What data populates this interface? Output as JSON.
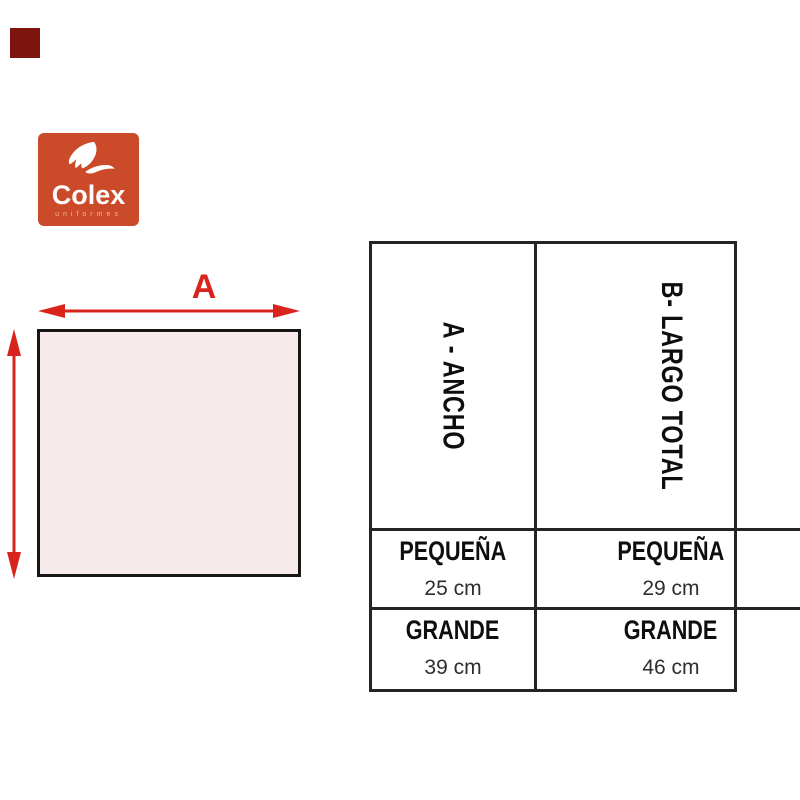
{
  "palette": {
    "brand_red": "#CB4A2A",
    "arrow_red": "#D9231D",
    "swatch_maroon": "#7D150E",
    "shape_fill": "#F6EAEB",
    "table_border": "#242424"
  },
  "logo": {
    "brand": "Colex",
    "tagline": "uniformes"
  },
  "diagram": {
    "width_label": "A"
  },
  "size_table": {
    "columns": [
      {
        "header": "A - ANCHO",
        "rows": [
          {
            "size": "PEQUEÑA",
            "value": "25 cm"
          },
          {
            "size": "GRANDE",
            "value": "39 cm"
          }
        ]
      },
      {
        "header": "B- LARGO TOTAL",
        "rows": [
          {
            "size": "PEQUEÑA",
            "value": "29 cm"
          },
          {
            "size": "GRANDE",
            "value": "46 cm"
          }
        ]
      }
    ]
  }
}
